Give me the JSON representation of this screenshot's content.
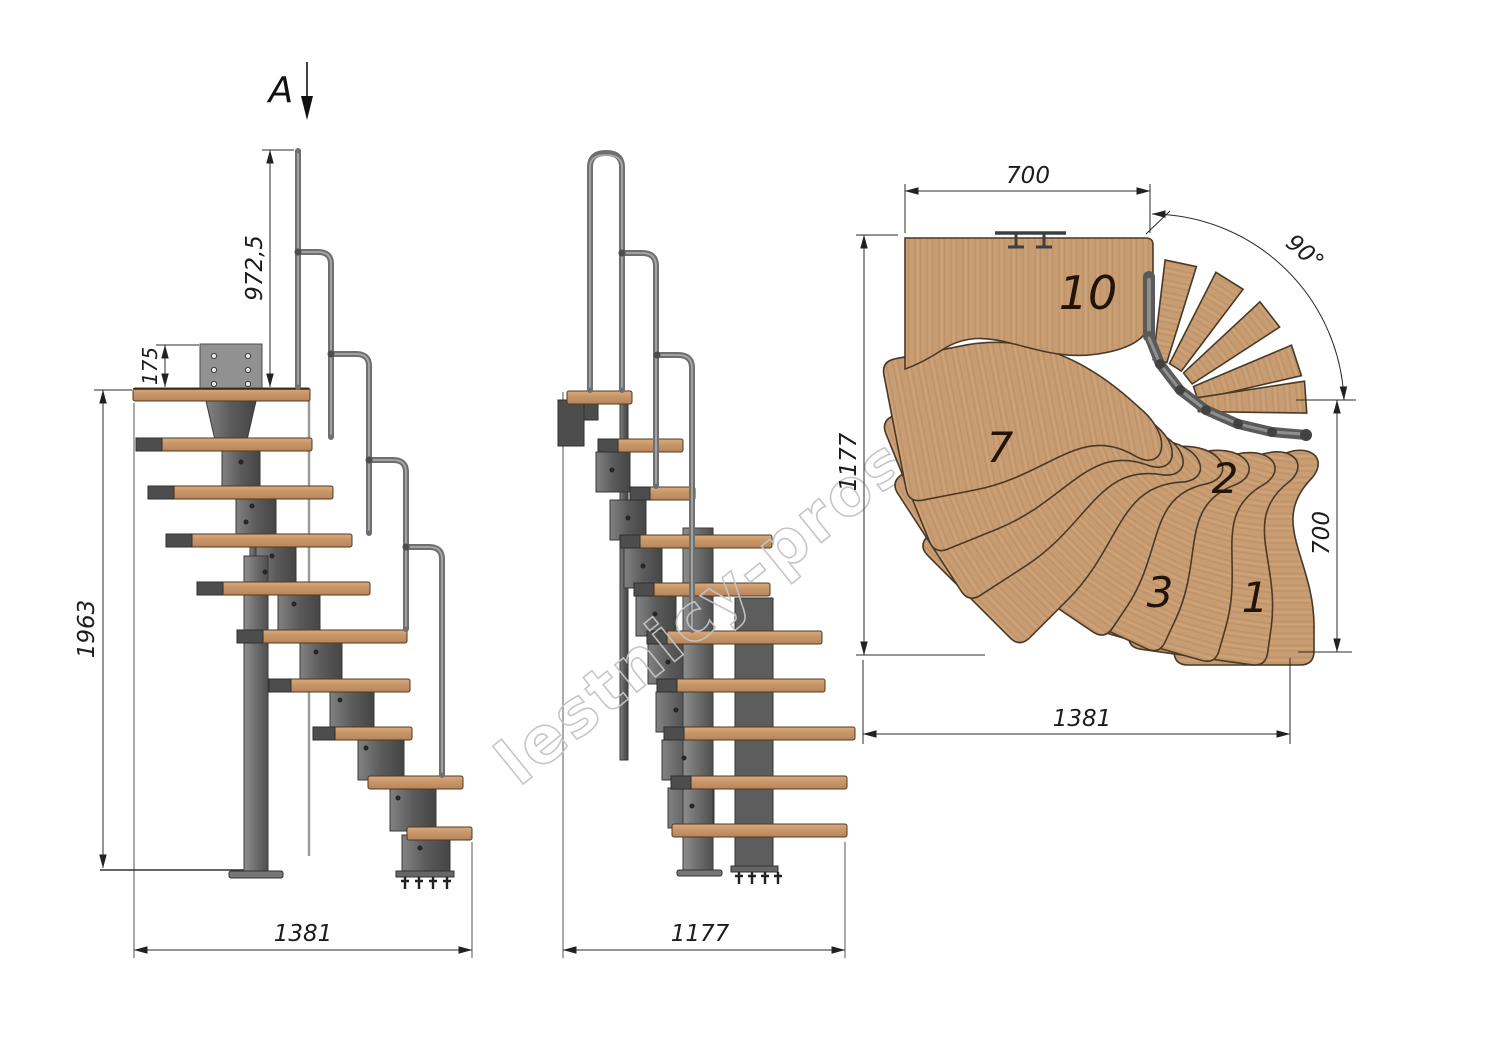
{
  "page": {
    "background": "#ffffff"
  },
  "watermark": {
    "text": "lestnicy-prosto.ru",
    "color": "#c4c4c4"
  },
  "section_marker": {
    "label": "A"
  },
  "side_elevation": {
    "name": "side elevation",
    "dimensions": {
      "handrail_height": "972,5",
      "bracket_offset": "175",
      "total_height": "1963",
      "base_length": "1381"
    }
  },
  "front_elevation": {
    "name": "front elevation",
    "dimensions": {
      "base_width": "1177"
    }
  },
  "plan_view": {
    "name": "top plan view",
    "dimensions": {
      "upper_flight_width": "700",
      "left_depth": "1177",
      "turn_angle": "90°",
      "lower_flight_width": "700",
      "total_length": "1381"
    },
    "tread_labels": [
      {
        "label": "10"
      },
      {
        "label": "7"
      },
      {
        "label": "3"
      },
      {
        "label": "2"
      },
      {
        "label": "1"
      }
    ]
  },
  "colors": {
    "wood_light": "#d8ac7c",
    "wood_dark": "#b8855a",
    "metal": "#5a5a5a",
    "dimension_line": "#2b2b2b",
    "watermark": "#c4c4c4"
  }
}
